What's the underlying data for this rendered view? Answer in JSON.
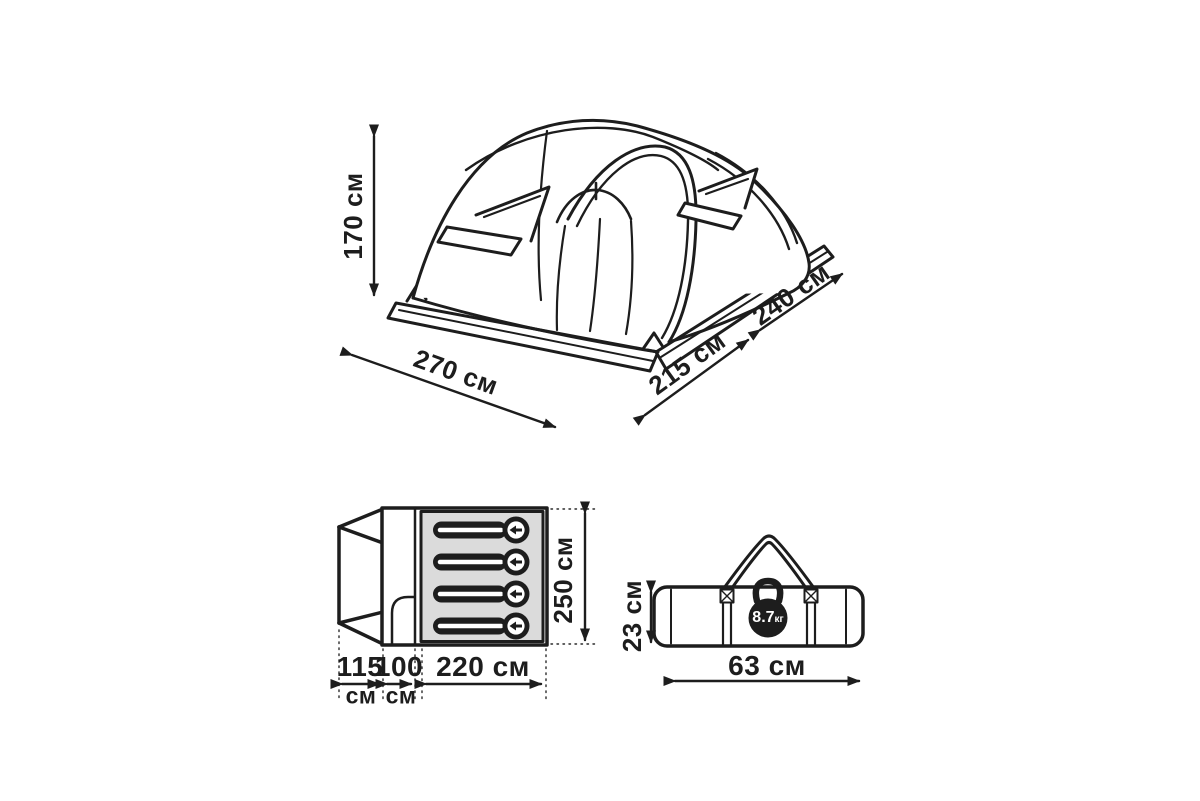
{
  "page": {
    "background": "#ffffff"
  },
  "colors": {
    "line": "#1d1d1d",
    "bedroom_fill": "#dbdbdb",
    "sleeping_bag_fill": "#1d1d1d"
  },
  "tent_view": {
    "height_label": "170 см",
    "front_width_label": "270 см",
    "side_depth_label": "215 см",
    "rear_depth_label": "240 см"
  },
  "floor_plan": {
    "vestibule_width": {
      "value": "115",
      "unit": "см"
    },
    "tambour_width": {
      "value": "100",
      "unit": "см"
    },
    "bedroom_width_label": "220 см",
    "bedroom_depth_label": "250 см",
    "sleeping_places": 4
  },
  "packed_bag": {
    "height_label": "23 см",
    "length_label": "63 см",
    "weight": {
      "value": "8.7",
      "unit": "кг"
    }
  }
}
